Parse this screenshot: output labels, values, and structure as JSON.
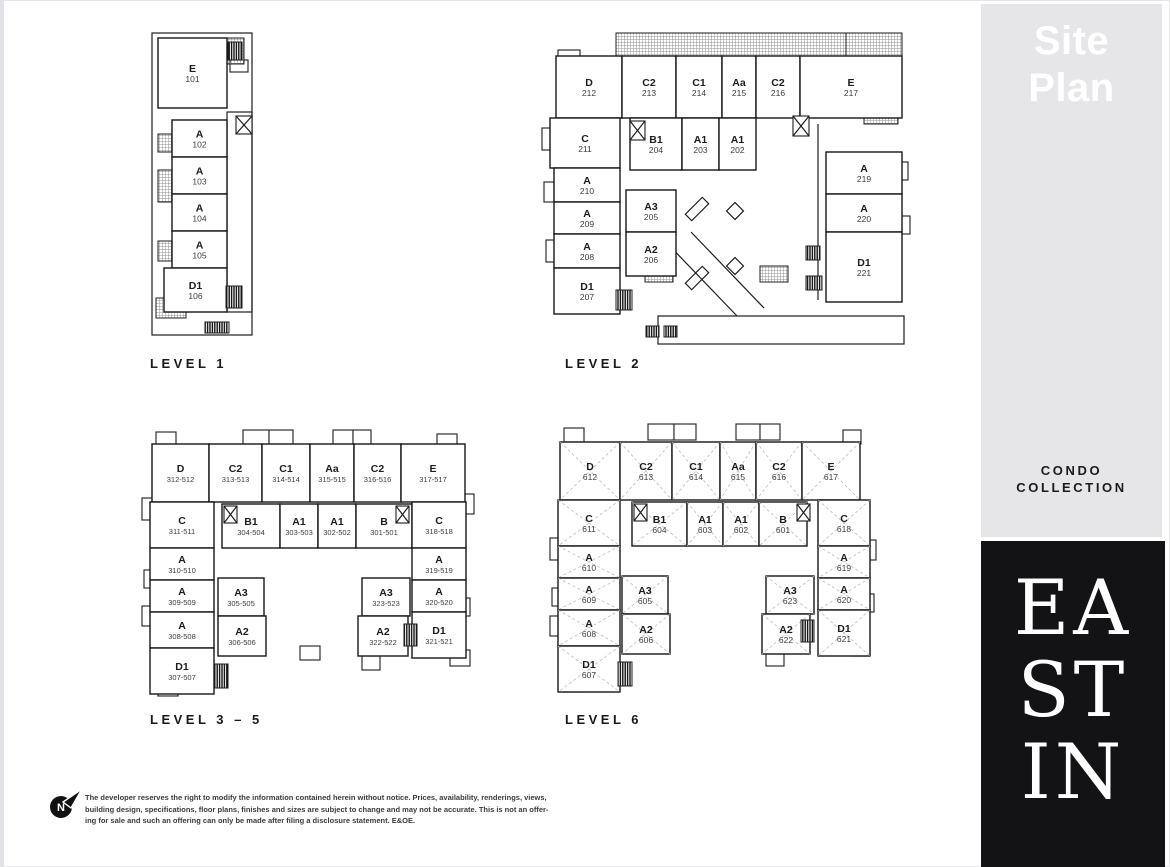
{
  "header": {
    "title_line1": "Site",
    "title_line2": "Plan"
  },
  "sidebar": {
    "collection_line1": "CONDO",
    "collection_line2": "COLLECTION",
    "brand": [
      "EA",
      "ST",
      "IN"
    ]
  },
  "colors": {
    "sidebar_gray": "#e6e6e8",
    "brand_black": "#131316",
    "plan_line": "#1d1d1d",
    "label_text": "#191919"
  },
  "footer": {
    "north_label": "N",
    "lines": [
      "The developer reserves the right to modify the information contained herein without notice. Prices, availability, renderings, views,",
      "building design, specifications, floor plans, finishes and sizes are subject to change and may not be accurate. This is not an offer-",
      "ing for sale and such an offering can only be made after filing a disclosure statement. E&OE."
    ]
  },
  "levels": [
    {
      "id": "1",
      "name": "LEVEL 1",
      "label_x": 150,
      "label_y": 356,
      "dashed": false,
      "small_num": false,
      "rects": [
        [
          152,
          33,
          100,
          302
        ],
        [
          227,
          112,
          25,
          200
        ]
      ],
      "bumps": [
        [
          230,
          60,
          18,
          12
        ]
      ],
      "hatches": [
        [
          158,
          48,
          26,
          20
        ],
        [
          158,
          134,
          26,
          18
        ],
        [
          158,
          170,
          26,
          32
        ],
        [
          158,
          241,
          26,
          20
        ],
        [
          156,
          298,
          30,
          20
        ],
        [
          222,
          38,
          22,
          26
        ]
      ],
      "combs": [
        [
          228,
          42,
          14,
          18
        ],
        [
          226,
          286,
          16,
          22
        ],
        [
          205,
          322,
          24,
          11
        ]
      ],
      "xboxes": [
        [
          236,
          116,
          16,
          18
        ]
      ],
      "lines": [],
      "marks": [],
      "units": [
        {
          "c": "E",
          "n": "101",
          "x": 158,
          "y": 38,
          "w": 69,
          "h": 70
        },
        {
          "c": "A",
          "n": "102",
          "x": 172,
          "y": 120,
          "w": 55,
          "h": 37
        },
        {
          "c": "A",
          "n": "103",
          "x": 172,
          "y": 157,
          "w": 55,
          "h": 37
        },
        {
          "c": "A",
          "n": "104",
          "x": 172,
          "y": 194,
          "w": 55,
          "h": 37
        },
        {
          "c": "A",
          "n": "105",
          "x": 172,
          "y": 231,
          "w": 55,
          "h": 37
        },
        {
          "c": "D1",
          "n": "106",
          "x": 164,
          "y": 268,
          "w": 63,
          "h": 44
        }
      ]
    },
    {
      "id": "2",
      "name": "LEVEL 2",
      "label_x": 565,
      "label_y": 356,
      "dashed": false,
      "small_num": false,
      "rects": [
        [
          658,
          316,
          246,
          28
        ]
      ],
      "bumps": [
        [
          558,
          50,
          22,
          14
        ],
        [
          542,
          128,
          12,
          22
        ],
        [
          544,
          182,
          10,
          20
        ],
        [
          546,
          240,
          12,
          22
        ],
        [
          896,
          162,
          12,
          18
        ],
        [
          898,
          216,
          12,
          18
        ]
      ],
      "hatches": [
        [
          616,
          33,
          230,
          24
        ],
        [
          846,
          33,
          56,
          36
        ],
        [
          864,
          104,
          34,
          20
        ],
        [
          662,
          156,
          22,
          14
        ],
        [
          698,
          150,
          42,
          16
        ],
        [
          645,
          266,
          28,
          16
        ],
        [
          760,
          266,
          28,
          16
        ],
        [
          864,
          212,
          18,
          16
        ],
        [
          858,
          264,
          20,
          16
        ]
      ],
      "combs": [
        [
          806,
          246,
          14,
          14
        ],
        [
          806,
          276,
          16,
          14
        ],
        [
          646,
          326,
          13,
          11
        ],
        [
          664,
          326,
          13,
          11
        ],
        [
          616,
          290,
          16,
          20
        ]
      ],
      "xboxes": [
        [
          630,
          121,
          15,
          19
        ],
        [
          793,
          116,
          16,
          20
        ]
      ],
      "lines": [
        [
          664,
          240,
          737,
          316
        ],
        [
          691,
          232,
          764,
          308
        ],
        [
          818,
          124,
          818,
          300
        ]
      ],
      "marks": [
        [
          "d",
          735,
          211
        ],
        [
          "d",
          735,
          266
        ],
        [
          "r",
          697,
          209
        ],
        [
          "r",
          697,
          278
        ]
      ],
      "units": [
        {
          "c": "D",
          "n": "212",
          "x": 556,
          "y": 56,
          "w": 66,
          "h": 62
        },
        {
          "c": "C2",
          "n": "213",
          "x": 622,
          "y": 56,
          "w": 54,
          "h": 62
        },
        {
          "c": "C1",
          "n": "214",
          "x": 676,
          "y": 56,
          "w": 46,
          "h": 62
        },
        {
          "c": "Aa",
          "n": "215",
          "x": 722,
          "y": 56,
          "w": 34,
          "h": 62
        },
        {
          "c": "C2",
          "n": "216",
          "x": 756,
          "y": 56,
          "w": 44,
          "h": 62
        },
        {
          "c": "E",
          "n": "217",
          "x": 800,
          "y": 56,
          "w": 102,
          "h": 62
        },
        {
          "c": "C",
          "n": "211",
          "x": 550,
          "y": 118,
          "w": 70,
          "h": 50
        },
        {
          "c": "A",
          "n": "210",
          "x": 554,
          "y": 168,
          "w": 66,
          "h": 34
        },
        {
          "c": "A",
          "n": "209",
          "x": 554,
          "y": 202,
          "w": 66,
          "h": 32
        },
        {
          "c": "A",
          "n": "208",
          "x": 554,
          "y": 234,
          "w": 66,
          "h": 34
        },
        {
          "c": "D1",
          "n": "207",
          "x": 554,
          "y": 268,
          "w": 66,
          "h": 46
        },
        {
          "c": "B1",
          "n": "204",
          "x": 630,
          "y": 118,
          "w": 52,
          "h": 52
        },
        {
          "c": "A1",
          "n": "203",
          "x": 682,
          "y": 118,
          "w": 37,
          "h": 52
        },
        {
          "c": "A1",
          "n": "202",
          "x": 719,
          "y": 118,
          "w": 37,
          "h": 52
        },
        {
          "c": "A3",
          "n": "205",
          "x": 626,
          "y": 190,
          "w": 50,
          "h": 42
        },
        {
          "c": "A2",
          "n": "206",
          "x": 626,
          "y": 232,
          "w": 50,
          "h": 44
        },
        {
          "c": "A",
          "n": "219",
          "x": 826,
          "y": 152,
          "w": 76,
          "h": 42
        },
        {
          "c": "A",
          "n": "220",
          "x": 826,
          "y": 194,
          "w": 76,
          "h": 38
        },
        {
          "c": "D1",
          "n": "221",
          "x": 826,
          "y": 232,
          "w": 76,
          "h": 70
        }
      ]
    },
    {
      "id": "3-5",
      "name": "LEVEL 3 – 5",
      "label_x": 150,
      "label_y": 712,
      "dashed": false,
      "small_num": true,
      "rects": [],
      "bumps": [
        [
          243,
          430,
          26,
          16
        ],
        [
          269,
          430,
          24,
          16
        ],
        [
          333,
          430,
          20,
          16
        ],
        [
          353,
          430,
          18,
          16
        ],
        [
          156,
          432,
          20,
          14
        ],
        [
          437,
          434,
          20,
          14
        ],
        [
          142,
          498,
          12,
          22
        ],
        [
          144,
          570,
          10,
          18
        ],
        [
          142,
          606,
          12,
          20
        ],
        [
          158,
          680,
          20,
          16
        ],
        [
          462,
          494,
          12,
          20
        ],
        [
          458,
          598,
          12,
          18
        ],
        [
          300,
          646,
          20,
          14
        ],
        [
          362,
          656,
          18,
          14
        ],
        [
          450,
          650,
          20,
          16
        ]
      ],
      "hatches": [],
      "combs": [
        [
          214,
          664,
          14,
          24
        ],
        [
          404,
          624,
          13,
          22
        ]
      ],
      "xboxes": [
        [
          224,
          506,
          13,
          17
        ],
        [
          396,
          506,
          13,
          17
        ]
      ],
      "lines": [],
      "marks": [],
      "units": [
        {
          "c": "D",
          "n": "312-512",
          "x": 152,
          "y": 444,
          "w": 57,
          "h": 58
        },
        {
          "c": "C2",
          "n": "313-513",
          "x": 209,
          "y": 444,
          "w": 53,
          "h": 58
        },
        {
          "c": "C1",
          "n": "314-514",
          "x": 262,
          "y": 444,
          "w": 48,
          "h": 58
        },
        {
          "c": "Aa",
          "n": "315-515",
          "x": 310,
          "y": 444,
          "w": 44,
          "h": 58
        },
        {
          "c": "C2",
          "n": "316-516",
          "x": 354,
          "y": 444,
          "w": 47,
          "h": 58
        },
        {
          "c": "E",
          "n": "317-517",
          "x": 401,
          "y": 444,
          "w": 64,
          "h": 58
        },
        {
          "c": "C",
          "n": "311-511",
          "x": 150,
          "y": 502,
          "w": 64,
          "h": 46
        },
        {
          "c": "B1",
          "n": "304-504",
          "x": 222,
          "y": 504,
          "w": 58,
          "h": 44
        },
        {
          "c": "A1",
          "n": "303-503",
          "x": 280,
          "y": 504,
          "w": 38,
          "h": 44
        },
        {
          "c": "A1",
          "n": "302-502",
          "x": 318,
          "y": 504,
          "w": 38,
          "h": 44
        },
        {
          "c": "B",
          "n": "301-501",
          "x": 356,
          "y": 504,
          "w": 56,
          "h": 44
        },
        {
          "c": "C",
          "n": "318-518",
          "x": 412,
          "y": 502,
          "w": 54,
          "h": 46
        },
        {
          "c": "A",
          "n": "310-510",
          "x": 150,
          "y": 548,
          "w": 64,
          "h": 32
        },
        {
          "c": "A",
          "n": "309-509",
          "x": 150,
          "y": 580,
          "w": 64,
          "h": 32
        },
        {
          "c": "A",
          "n": "308-508",
          "x": 150,
          "y": 612,
          "w": 64,
          "h": 36
        },
        {
          "c": "D1",
          "n": "307-507",
          "x": 150,
          "y": 648,
          "w": 64,
          "h": 46
        },
        {
          "c": "A3",
          "n": "305-505",
          "x": 218,
          "y": 578,
          "w": 46,
          "h": 38
        },
        {
          "c": "A2",
          "n": "306-506",
          "x": 218,
          "y": 616,
          "w": 48,
          "h": 40
        },
        {
          "c": "A3",
          "n": "323-523",
          "x": 362,
          "y": 578,
          "w": 48,
          "h": 38
        },
        {
          "c": "A2",
          "n": "322-522",
          "x": 358,
          "y": 616,
          "w": 50,
          "h": 40
        },
        {
          "c": "A",
          "n": "319-519",
          "x": 412,
          "y": 548,
          "w": 54,
          "h": 32
        },
        {
          "c": "A",
          "n": "320-520",
          "x": 412,
          "y": 580,
          "w": 54,
          "h": 32
        },
        {
          "c": "D1",
          "n": "321-521",
          "x": 412,
          "y": 612,
          "w": 54,
          "h": 46
        }
      ]
    },
    {
      "id": "6",
      "name": "LEVEL 6",
      "label_x": 565,
      "label_y": 712,
      "dashed": true,
      "small_num": false,
      "rects": [],
      "bumps": [
        [
          648,
          424,
          26,
          16
        ],
        [
          674,
          424,
          22,
          16
        ],
        [
          736,
          424,
          24,
          16
        ],
        [
          760,
          424,
          20,
          16
        ],
        [
          564,
          428,
          20,
          14
        ],
        [
          843,
          430,
          18,
          14
        ],
        [
          550,
          538,
          12,
          22
        ],
        [
          552,
          588,
          10,
          18
        ],
        [
          550,
          616,
          12,
          20
        ],
        [
          564,
          676,
          20,
          16
        ],
        [
          864,
          540,
          12,
          20
        ],
        [
          862,
          594,
          12,
          18
        ],
        [
          766,
          652,
          18,
          14
        ],
        [
          854,
          640,
          16,
          16
        ]
      ],
      "hatches": [],
      "combs": [
        [
          618,
          662,
          14,
          24
        ],
        [
          801,
          620,
          13,
          22
        ]
      ],
      "xboxes": [
        [
          634,
          504,
          13,
          17
        ],
        [
          797,
          504,
          13,
          17
        ]
      ],
      "lines": [],
      "marks": [],
      "units": [
        {
          "c": "D",
          "n": "612",
          "x": 560,
          "y": 442,
          "w": 60,
          "h": 58
        },
        {
          "c": "C2",
          "n": "613",
          "x": 620,
          "y": 442,
          "w": 52,
          "h": 58
        },
        {
          "c": "C1",
          "n": "614",
          "x": 672,
          "y": 442,
          "w": 48,
          "h": 58
        },
        {
          "c": "Aa",
          "n": "615",
          "x": 720,
          "y": 442,
          "w": 36,
          "h": 58
        },
        {
          "c": "C2",
          "n": "616",
          "x": 756,
          "y": 442,
          "w": 46,
          "h": 58
        },
        {
          "c": "E",
          "n": "617",
          "x": 802,
          "y": 442,
          "w": 58,
          "h": 58
        },
        {
          "c": "C",
          "n": "611",
          "x": 558,
          "y": 500,
          "w": 62,
          "h": 46
        },
        {
          "c": "B1",
          "n": "604",
          "x": 632,
          "y": 502,
          "w": 55,
          "h": 44
        },
        {
          "c": "A1",
          "n": "603",
          "x": 687,
          "y": 502,
          "w": 36,
          "h": 44
        },
        {
          "c": "A1",
          "n": "602",
          "x": 723,
          "y": 502,
          "w": 36,
          "h": 44
        },
        {
          "c": "B",
          "n": "601",
          "x": 759,
          "y": 502,
          "w": 48,
          "h": 44
        },
        {
          "c": "C",
          "n": "618",
          "x": 818,
          "y": 500,
          "w": 52,
          "h": 46
        },
        {
          "c": "A",
          "n": "610",
          "x": 558,
          "y": 546,
          "w": 62,
          "h": 32
        },
        {
          "c": "A",
          "n": "609",
          "x": 558,
          "y": 578,
          "w": 62,
          "h": 32
        },
        {
          "c": "A",
          "n": "608",
          "x": 558,
          "y": 610,
          "w": 62,
          "h": 36
        },
        {
          "c": "D1",
          "n": "607",
          "x": 558,
          "y": 646,
          "w": 62,
          "h": 46
        },
        {
          "c": "A3",
          "n": "605",
          "x": 622,
          "y": 576,
          "w": 46,
          "h": 38
        },
        {
          "c": "A2",
          "n": "606",
          "x": 622,
          "y": 614,
          "w": 48,
          "h": 40
        },
        {
          "c": "A3",
          "n": "623",
          "x": 766,
          "y": 576,
          "w": 48,
          "h": 38
        },
        {
          "c": "A2",
          "n": "622",
          "x": 762,
          "y": 614,
          "w": 48,
          "h": 40
        },
        {
          "c": "A",
          "n": "619",
          "x": 818,
          "y": 546,
          "w": 52,
          "h": 32
        },
        {
          "c": "A",
          "n": "620",
          "x": 818,
          "y": 578,
          "w": 52,
          "h": 32
        },
        {
          "c": "D1",
          "n": "621",
          "x": 818,
          "y": 610,
          "w": 52,
          "h": 46
        }
      ]
    }
  ]
}
